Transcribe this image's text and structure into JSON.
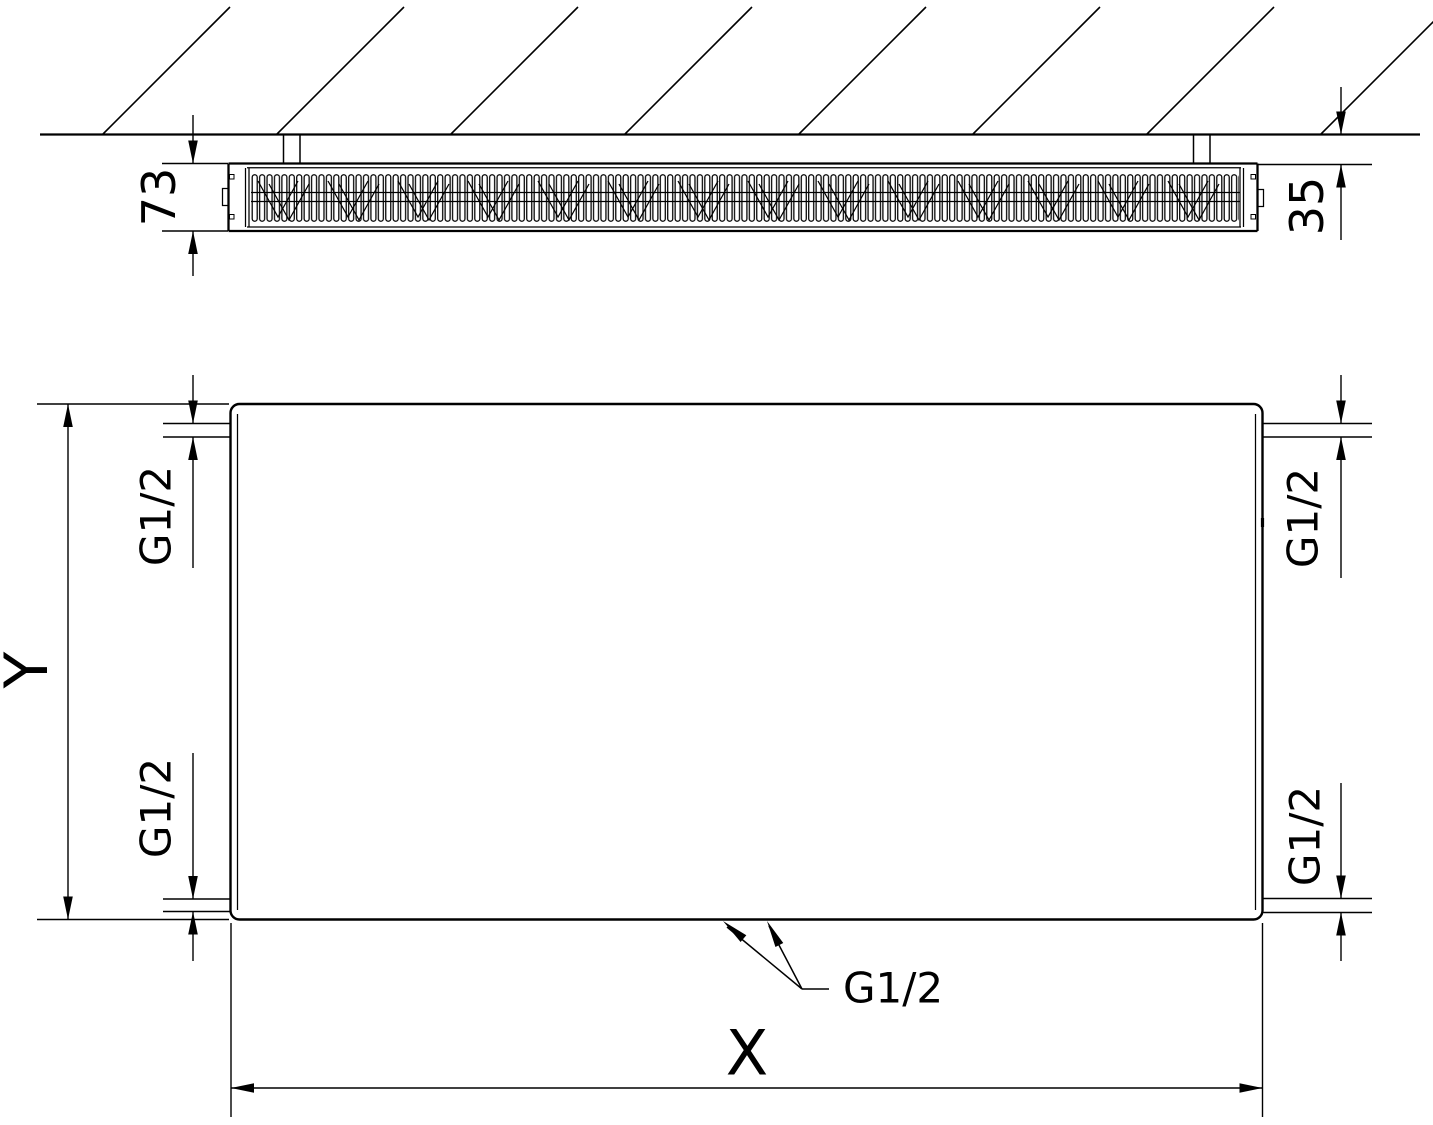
{
  "drawing": {
    "type": "radiator-technical-drawing",
    "top_view": {
      "description": "wall section with radiator depth profile",
      "dimensions": {
        "depth": "73",
        "wall_clearance": "35"
      }
    },
    "front_view": {
      "description": "radiator front panel with connection threads",
      "dimensions": {
        "height_label": "Y",
        "width_label": "X"
      },
      "connections": {
        "top_left": "G1/2",
        "top_right": "G1/2",
        "bottom_left": "G1/2",
        "bottom_right": "G1/2",
        "bottom_center": "G1/2"
      }
    },
    "colors": {
      "line": "#000000",
      "background": "#ffffff"
    }
  }
}
